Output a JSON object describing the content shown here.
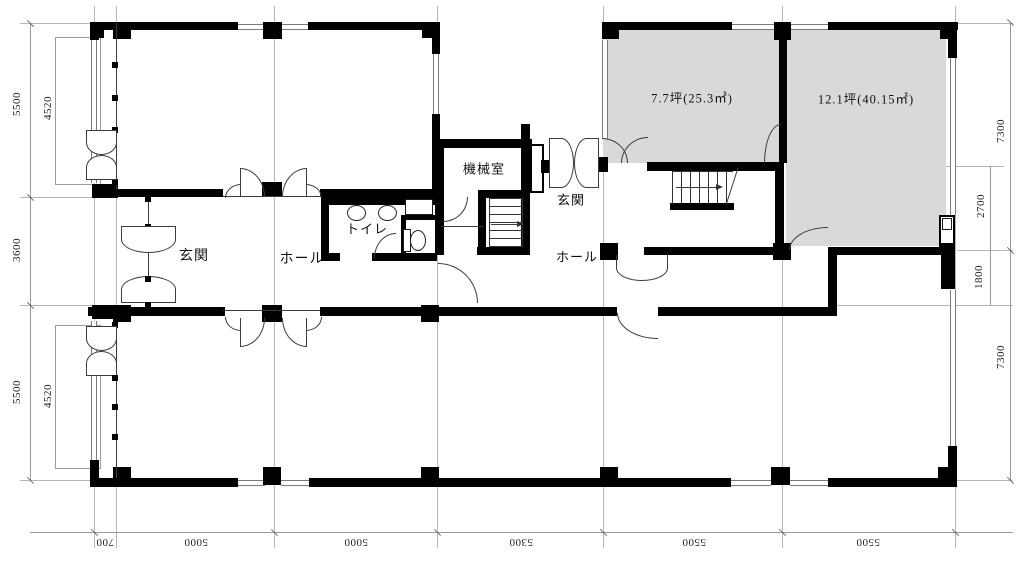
{
  "rooms": {
    "machine_room": "機械室",
    "toilet": "トイレ",
    "entrance_left": "玄関",
    "entrance_right": "玄関",
    "hall_left": "ホール",
    "hall_right": "ホール"
  },
  "areas": {
    "unit_a": "7.7坪(25.3㎡)",
    "unit_b": "12.1坪(40.15㎡)"
  },
  "dimensions": {
    "left": {
      "outer_top": "5500",
      "inner_top": "4520",
      "middle": "3600",
      "outer_bottom": "5500",
      "inner_bottom": "4520"
    },
    "right": {
      "outer_top": "7300",
      "inner_upper": "2700",
      "inner_lower": "1800",
      "outer_bottom": "7300"
    },
    "bottom": [
      "700",
      "5000",
      "5000",
      "5300",
      "5500",
      "5500"
    ]
  },
  "colors": {
    "wall": "#000000",
    "leased_room_fill": "#d9d9d9",
    "grid_line": "#b6b6b6",
    "dimension_text": "#222222"
  }
}
